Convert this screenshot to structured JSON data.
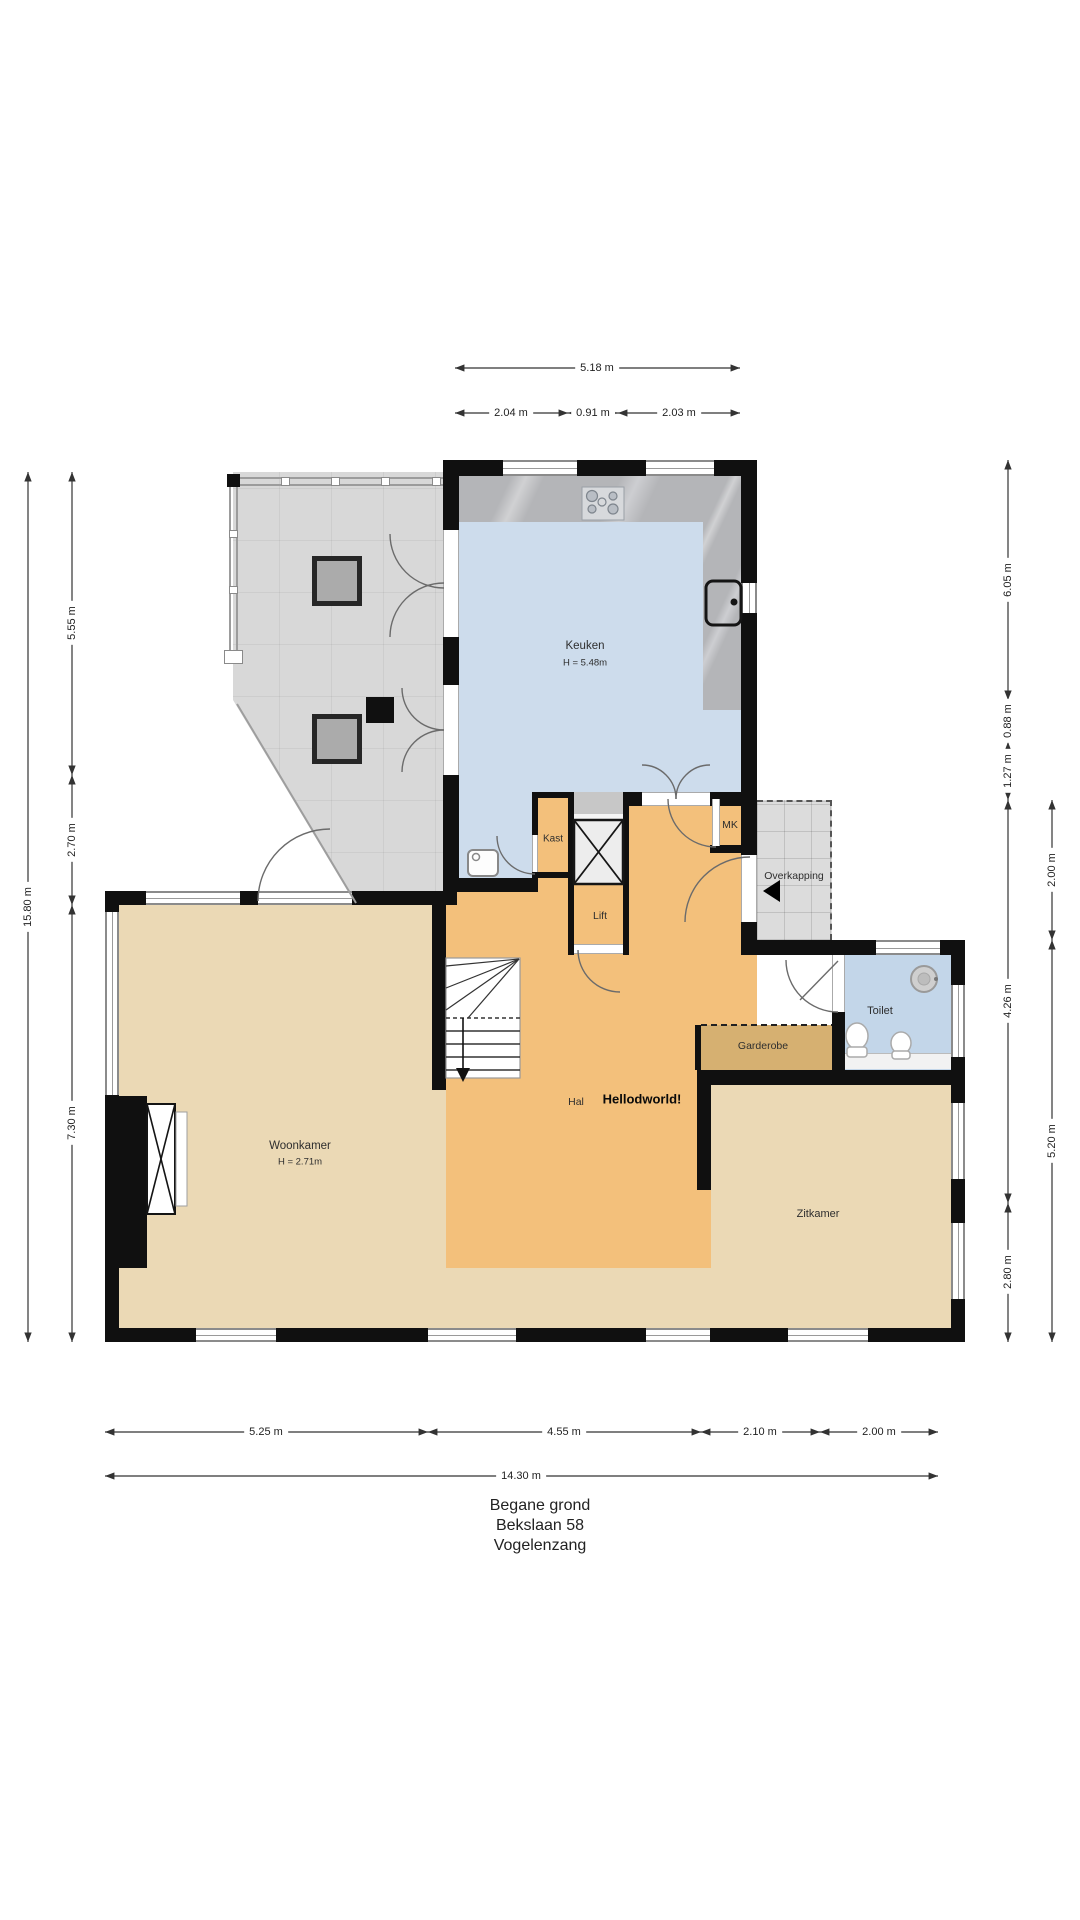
{
  "title": {
    "line1": "Begane grond",
    "line2": "Bekslaan 58",
    "line3": "Vogelenzang"
  },
  "rooms": {
    "keuken": "Keuken",
    "keuken_height": "H = 5.48m",
    "woonkamer": "Woonkamer",
    "woonkamer_height": "H = 2.71m",
    "zitkamer": "Zitkamer",
    "hal": "Hal",
    "hello": "Hellodworld!",
    "kast": "Kast",
    "lift": "Lift",
    "mk": "MK",
    "overkapping": "Overkapping",
    "garderobe": "Garderobe",
    "toilet": "Toilet"
  },
  "dims": {
    "top_total": "5.18 m",
    "top_a": "2.04 m",
    "top_b": "0.91 m",
    "top_c": "2.03 m",
    "left_total": "15.80 m",
    "left_a": "5.55 m",
    "left_b": "2.70 m",
    "left_c": "7.30 m",
    "right_a": "6.05 m",
    "right_b": "0.88 m",
    "right_c": "1.27 m",
    "right_d": "4.26 m",
    "right_e": "2.80 m",
    "right_f": "2.00 m",
    "right_g": "5.20 m",
    "bottom_a": "5.25 m",
    "bottom_b": "4.55 m",
    "bottom_c": "2.10 m",
    "bottom_d": "2.00 m",
    "bottom_total": "14.30 m"
  },
  "colors": {
    "wall": "#101010",
    "kitchen-floor": "#cddcec",
    "toilet-floor": "#c3d6e9",
    "hall-floor": "#f3c07b",
    "living-floor": "#ebd9b5",
    "wardrobe-floor": "#d6b071",
    "terrace": "#d8d8d8",
    "counter": "#b4b5b8",
    "dim-line": "#333333",
    "label-text": "#2e2e2e"
  }
}
